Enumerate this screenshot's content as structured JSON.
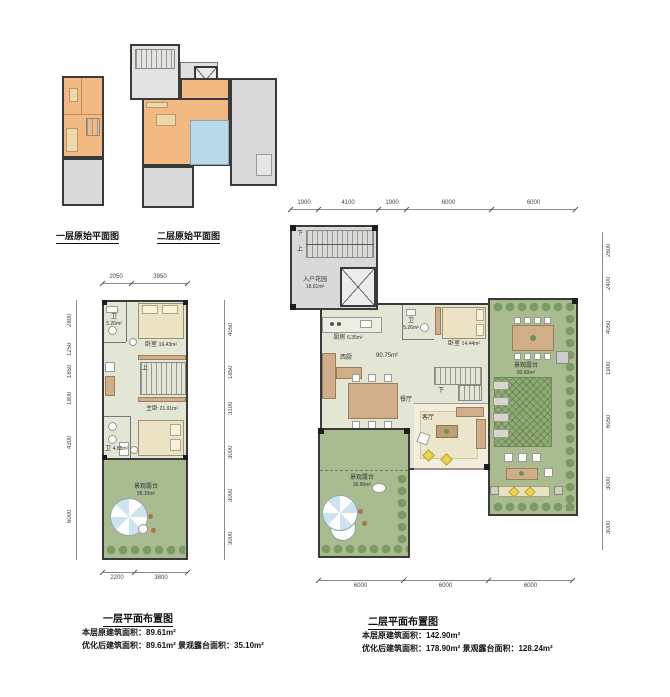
{
  "sheet": {
    "captions": {
      "original_l1": "一层原始平面图",
      "original_l2": "二层原始平面图",
      "layout_l1": "一层平面布置图",
      "layout_l2": "二层平面布置图"
    },
    "stats": {
      "l1_line1": "本层原建筑面积：89.61m²",
      "l1_line2": "优化后建筑面积：89.61m²  景观露台面积：35.10m²",
      "l2_line1": "本层原建筑面积：142.90m²",
      "l2_line2": "优化后建筑面积：178.90m²  景观露台面积：128.24m²"
    },
    "rooms_l1": {
      "bath1_name": "卫",
      "bath1_area": "5.26m²",
      "bed1_name": "卧室",
      "bed1_area": "16.43m²",
      "master_name": "主卧",
      "master_area": "21.91m²",
      "bath2_name": "卫",
      "bath2_area": "4.88m²",
      "terrace_name": "景观露台",
      "terrace_area": "35.10m²",
      "stair_up": "上"
    },
    "rooms_l2": {
      "entry_name": "入户花园",
      "entry_area": "18.61m²",
      "kitchen_name": "厨房",
      "kitchen_area": "6.35m²",
      "west_kitchen": "西厨",
      "dining": "餐厅",
      "hall_area": "90.75m²",
      "bath_name": "卫",
      "bath_area": "5.26m²",
      "bedroom_name": "卧室",
      "bedroom_area": "14.44m²",
      "living": "客厅",
      "terrace_right_name": "景观露台",
      "terrace_right_area": "90.60m²",
      "terrace_left_name": "景观露台",
      "terrace_left_area": "36.90m²",
      "stair_up": "上",
      "stair_down": "下"
    },
    "dims": {
      "l1_top": [
        "2050",
        "3950"
      ],
      "l1_bottom": [
        "2200",
        "3800"
      ],
      "l1_left": [
        "2800",
        "1250",
        "1850",
        "1800",
        "4300",
        "6000"
      ],
      "l1_right": [
        "4050",
        "1850",
        "3100",
        "3000",
        "3000",
        "3000"
      ],
      "l2_top": [
        "1900",
        "4100",
        "1900",
        "6000",
        "6000"
      ],
      "l2_bottom": [
        "6000",
        "6000",
        "6000"
      ],
      "l2_right": [
        "2600",
        "2400",
        "4050",
        "1900",
        "6050",
        "3000",
        "3000"
      ]
    },
    "colors": {
      "original_room": "#f2b983",
      "original_water": "#b9d9e9",
      "original_terrace": "#dadada",
      "floor": "#e3e5d5",
      "living_floor": "#f2eedb",
      "terrace_green": "#a9bc90",
      "lawn_hatch": "#90aa74",
      "wood": "#cfae89",
      "wall": "#3a3a3a"
    }
  }
}
